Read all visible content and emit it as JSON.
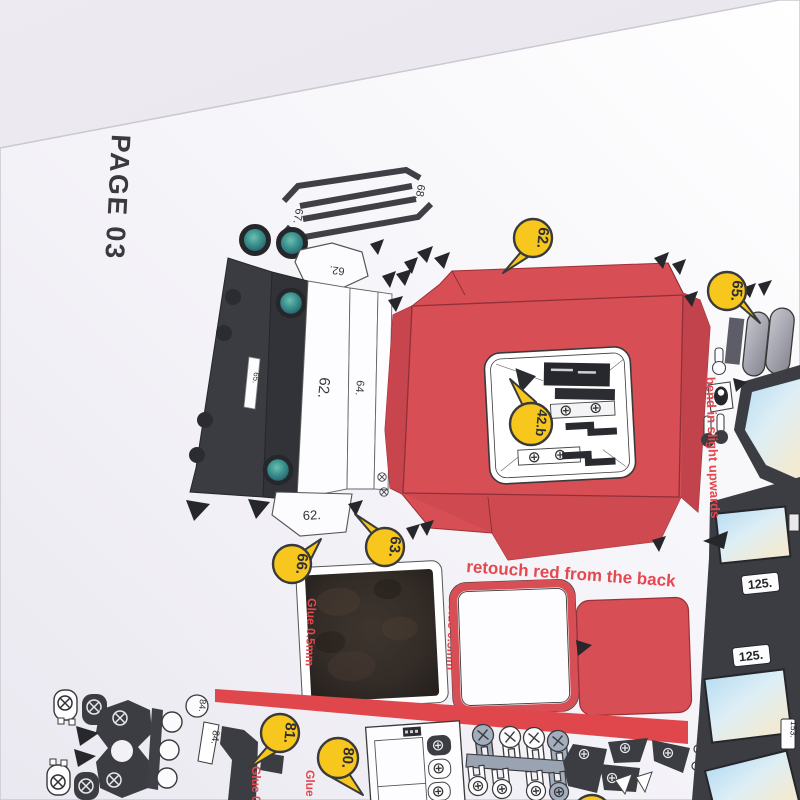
{
  "page": {
    "label": "PAGE 03"
  },
  "instructions": {
    "retouch": "retouch red from the back",
    "bend": "bend in slight upwards",
    "glue": "Glue 0.5mm"
  },
  "balloons": {
    "b62": "62.",
    "b63": "63.",
    "b65": "65.",
    "b66": "66.",
    "b80": "80.",
    "b81": "81.",
    "b42b": "42.b"
  },
  "part_labels": {
    "strip67": "67.",
    "strip68": "68.",
    "tab62_top": "62.",
    "slot65": "65.",
    "strip62": "62.",
    "strip64": "64.",
    "tab62_bottom": "62.",
    "circled84": "84.",
    "box84": "84.",
    "window125_upper": "125.",
    "window125_lower": "125.",
    "window153": "153."
  },
  "colors": {
    "background": "#e7e5eb",
    "paper": "#ffffff",
    "part_red": "#d74e55",
    "label_red": "#e5484f",
    "balloon_yellow": "#f7c71e",
    "part_dark": "#3c3d42",
    "glass_blue": "#b8ddf3",
    "glass_cream": "#f2ead2",
    "wheel_teal": "#3f9590"
  }
}
